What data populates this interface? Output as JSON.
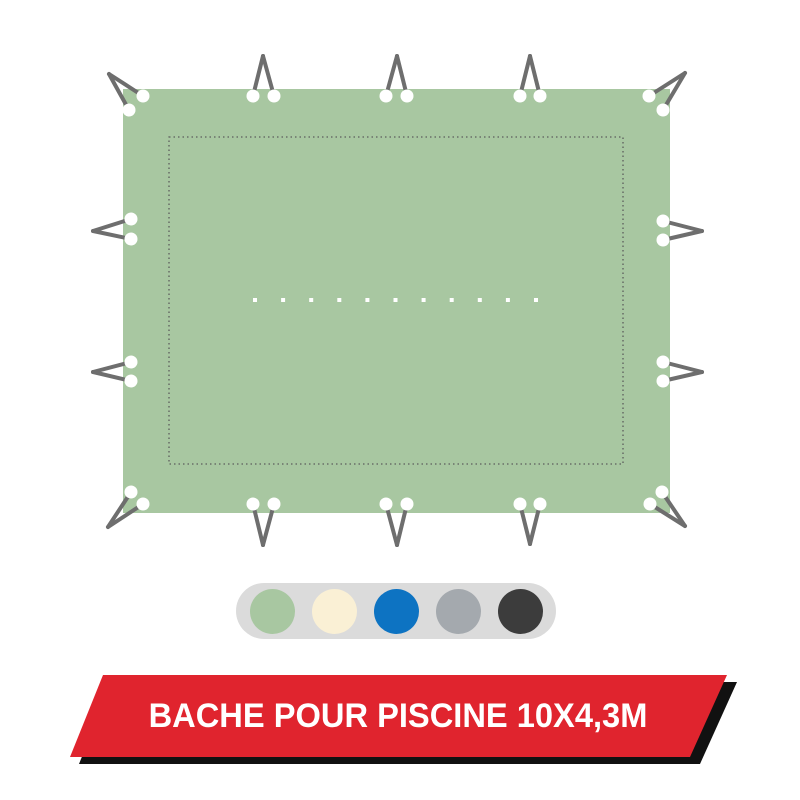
{
  "colors": {
    "page-bg": "#ffffff",
    "tarp-green": "#a8c7a1",
    "seam": "#5c5c5c",
    "cord": "#6e6e6e",
    "eyelet": "#ffffff",
    "center-dot": "#ffffff",
    "pill-bg": "#dbdbdb",
    "banner-red": "#e0242e",
    "banner-shadow": "#111111",
    "banner-text": "#ffffff"
  },
  "tarp": {
    "center_dot_count": 11
  },
  "swatches": {
    "options": [
      {
        "name": "green",
        "hex": "#a8c7a1"
      },
      {
        "name": "cream",
        "hex": "#faf0d5"
      },
      {
        "name": "blue",
        "hex": "#0d73c2"
      },
      {
        "name": "gray",
        "hex": "#a4a9ae"
      },
      {
        "name": "charcoal",
        "hex": "#3c3c3c"
      }
    ]
  },
  "banner": {
    "label": "BACHE POUR PISCINE 10X4,3M"
  }
}
